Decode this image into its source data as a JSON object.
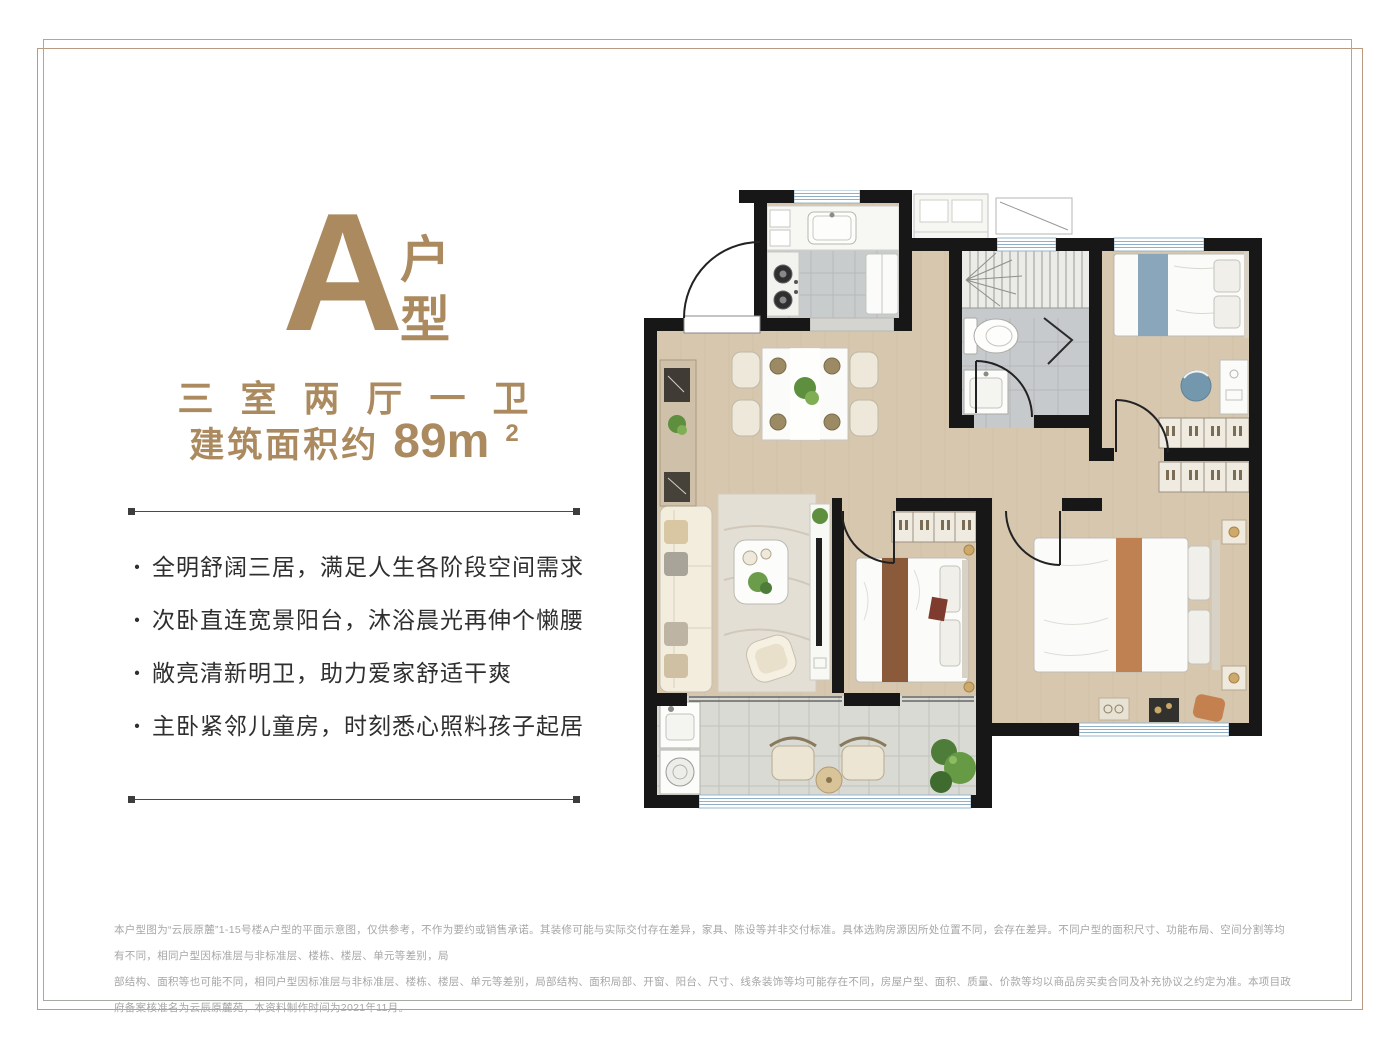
{
  "colors": {
    "accent": "#ab8a5f",
    "text_dark": "#2f2f2f",
    "text_gray": "#a6a6a6",
    "frame_tan": "#b79a82",
    "frame_gray": "#a6ab9f",
    "wall": "#171717",
    "wood_floor": "#d7c7ae",
    "tile_gray": "#c7cacc",
    "window_blue": "#8fb0c6"
  },
  "header": {
    "type_letter": "A",
    "type_label": "户型",
    "layout": "三室两厅一卫",
    "area_prefix": "建筑面积约",
    "area_value": "89m",
    "area_sup": "2"
  },
  "ui": {
    "bullet": "·"
  },
  "features": [
    "全明舒阔三居，满足人生各阶段空间需求",
    "次卧直连宽景阳台，沐浴晨光再伸个懒腰",
    "敞亮清新明卫，助力爱家舒适干爽",
    "主卧紧邻儿童房，时刻悉心照料孩子起居"
  ],
  "disclaimer": {
    "line1": "本户型图为“云辰原麓”1-15号楼A户型的平面示意图，仅供参考，不作为要约或销售承诺。其装修可能与实际交付存在差异，家具、陈设等并非交付标准。具体选购房源因所处位置不同，会存在差异。不同户型的面积尺寸、功能布局、空间分割等均有不同，相同户型因标准层与非标准层、楼栋、楼层、单元等差别，局",
    "line2": "部结构、面积等也可能不同，相同户型因标准层与非标准层、楼栋、楼层、单元等差别，局部结构、面积局部、开窗、阳台、尺寸、线条装饰等均可能存在不同，房屋户型、面积、质量、价款等均以商品房买卖合同及补充协议之约定为准。本项目政府备案核准名为云辰原麓苑，本资料制作时间为2021年11月。"
  }
}
